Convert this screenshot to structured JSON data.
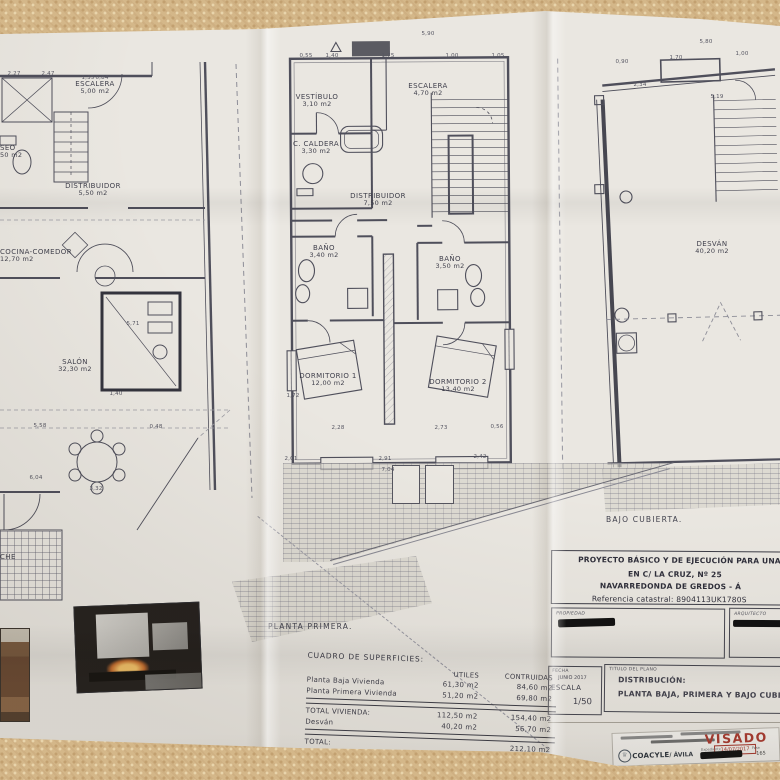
{
  "photo": {
    "tablecloth_color": "#d4b789",
    "paper_color": "#eae7e1",
    "line_color": "#4f4f5b",
    "accent_red": "#a93a30"
  },
  "plans": {
    "left": {
      "rooms": [
        {
          "name": "ESCALERA",
          "area": "5,00 m2"
        },
        {
          "name": "SEO",
          "area": "50 m2"
        },
        {
          "name": "DISTRIBUIDOR",
          "area": "5,50 m2"
        },
        {
          "name": "COCINA-COMEDOR",
          "area": "12,70 m2"
        },
        {
          "name": "SALÓN",
          "area": "32,30 m2"
        },
        {
          "name": "CHE",
          "area": ""
        }
      ]
    },
    "middle": {
      "caption": "PLANTA PRIMERA.",
      "rooms": [
        {
          "name": "VESTÍBULO",
          "area": "3,10 m2"
        },
        {
          "name": "ESCALERA",
          "area": "4,70 m2"
        },
        {
          "name": "C. CALDERA",
          "area": "3,30 m2"
        },
        {
          "name": "DISTRIBUIDOR",
          "area": "7,50 m2"
        },
        {
          "name": "BAÑO",
          "area": "3,40 m2"
        },
        {
          "name": "BAÑO",
          "area": "3,50 m2"
        },
        {
          "name": "DORMITORIO 1",
          "area": "12,00 m2"
        },
        {
          "name": "DORMITORIO 2",
          "area": "13,40 m2"
        }
      ]
    },
    "right": {
      "caption": "BAJO CUBIERTA.",
      "rooms": [
        {
          "name": "DESVÁN",
          "area": "40,20 m2"
        }
      ]
    }
  },
  "dimensions": [
    {
      "t": "5,90",
      "x": 428,
      "y": 34
    },
    {
      "t": "0,55",
      "x": 306,
      "y": 56
    },
    {
      "t": "1,40",
      "x": 332,
      "y": 56
    },
    {
      "t": "1,75",
      "x": 388,
      "y": 56
    },
    {
      "t": "1,00",
      "x": 452,
      "y": 56
    },
    {
      "t": "1,05",
      "x": 498,
      "y": 56
    },
    {
      "t": "5,80",
      "x": 706,
      "y": 42
    },
    {
      "t": "0,90",
      "x": 622,
      "y": 62
    },
    {
      "t": "1,70",
      "x": 676,
      "y": 58
    },
    {
      "t": "1,00",
      "x": 742,
      "y": 54
    },
    {
      "t": "2,27",
      "x": 14,
      "y": 74
    },
    {
      "t": "2,47",
      "x": 48,
      "y": 74
    },
    {
      "t": "1,35",
      "x": 88,
      "y": 78
    },
    {
      "t": "0,84",
      "x": 102,
      "y": 78
    },
    {
      "t": "5,71",
      "x": 133,
      "y": 324
    },
    {
      "t": "1,40",
      "x": 116,
      "y": 394
    },
    {
      "t": "1,72",
      "x": 293,
      "y": 396
    },
    {
      "t": "0,48",
      "x": 156,
      "y": 427
    },
    {
      "t": "5,58",
      "x": 40,
      "y": 426
    },
    {
      "t": "6,04",
      "x": 36,
      "y": 478
    },
    {
      "t": "3,32",
      "x": 96,
      "y": 489
    },
    {
      "t": "2,28",
      "x": 338,
      "y": 428
    },
    {
      "t": "2,73",
      "x": 441,
      "y": 428
    },
    {
      "t": "0,56",
      "x": 497,
      "y": 427
    },
    {
      "t": "2,01",
      "x": 291,
      "y": 459
    },
    {
      "t": "2,91",
      "x": 385,
      "y": 459
    },
    {
      "t": "2,42",
      "x": 480,
      "y": 457
    },
    {
      "t": "7,04",
      "x": 388,
      "y": 470
    },
    {
      "t": "2,34",
      "x": 640,
      "y": 85
    },
    {
      "t": "5,19",
      "x": 717,
      "y": 97
    }
  ],
  "areas_table": {
    "title": "CUADRO DE SUPERFICIES:",
    "col_utiles": "UTILES",
    "col_construidas": "CONTRUIDAS",
    "rows": [
      {
        "label": "Planta Baja Vivienda",
        "utiles": "61,30 m2",
        "construidas": "84,60 m2"
      },
      {
        "label": "Planta Primera Vivienda",
        "utiles": "51,20 m2",
        "construidas": "69,80 m2"
      }
    ],
    "total_vivienda": {
      "label": "TOTAL VIVIENDA:",
      "utiles": "112,50 m2",
      "construidas": "154,40 m2"
    },
    "desvan": {
      "label": "Desván",
      "utiles": "40,20 m2",
      "construidas": "56,70 m2"
    },
    "total": {
      "label": "TOTAL:",
      "value": "212,10 m2"
    }
  },
  "title_block": {
    "project_line1": "PROYECTO BÁSICO Y DE EJECUCIÓN PARA UNA VIVIE",
    "project_line2": "EN C/ LA CRUZ, Nº 25",
    "project_line3": "NAVARREDONDA DE GREDOS - Á",
    "project_line4": "Referencia catastral: 8904113UK1780S",
    "propiedad_label": "PROPIEDAD",
    "arquitecto_label": "ARQUITECTO",
    "fecha_label": "FECHA",
    "fecha_value": "JUNIO 2017",
    "escala_label": "ESCALA",
    "escala_value": "1/50",
    "titulo_plano_label": "TITULO DEL PLANO",
    "titulo_line1": "DISTRIBUCIÓN:",
    "titulo_line2": "PLANTA BAJA, PRIMERA Y BAJO CUBIERTA."
  },
  "stamp": {
    "visado": "VISADO",
    "date": "14/07/2017",
    "org": "COACYLE",
    "org_city": "/ ÁVILA",
    "expediente_label": "Expediente",
    "fase_label": "Fase",
    "numero": "165"
  }
}
